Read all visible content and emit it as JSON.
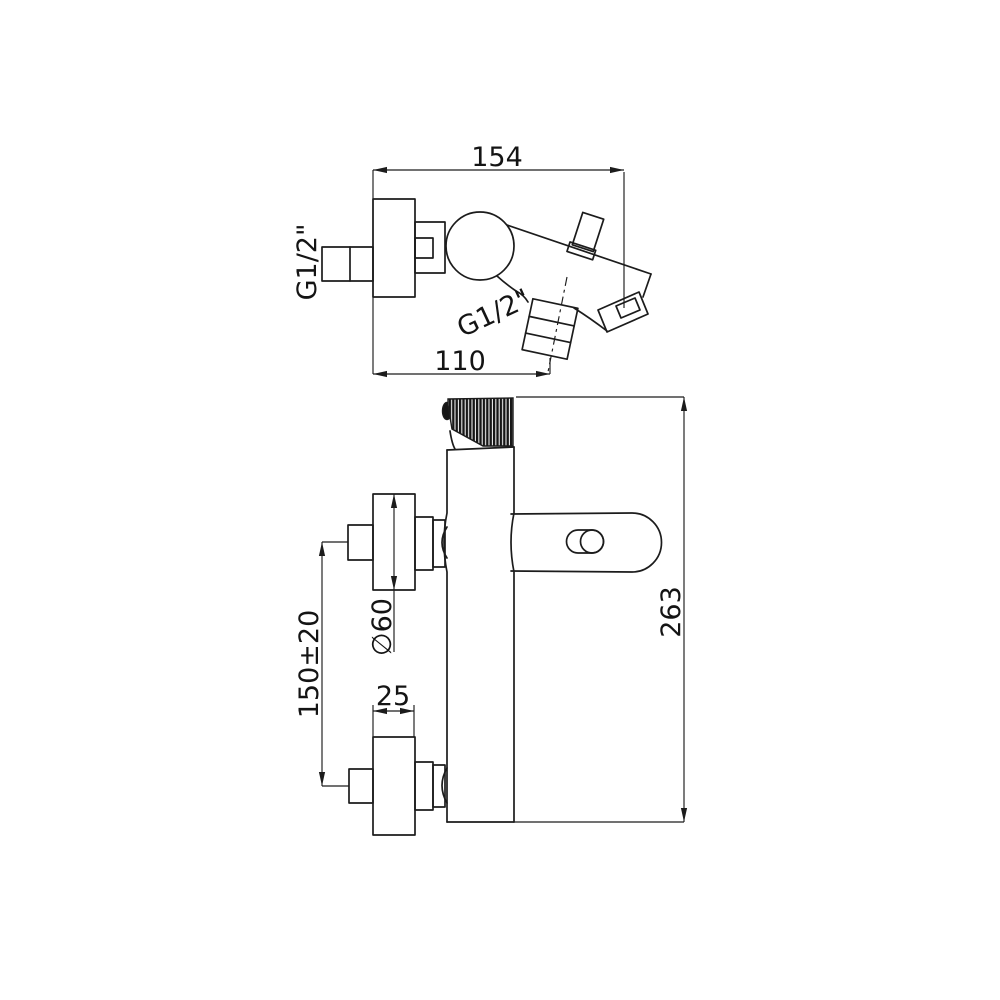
{
  "canvas": {
    "background": "#ffffff",
    "line_color": "#1c1c1c"
  },
  "drawing": {
    "kind": "technical dimension drawing, bath-shower wall mixer, two orthographic views",
    "side_view": {
      "dim_width": "154",
      "dim_reach": "110",
      "inlet_thread_label": "G1/2\"",
      "handshower_thread_label": "G1/2\""
    },
    "front_view": {
      "dim_height": "263",
      "dim_escutcheon_diameter": "∅60",
      "dim_inlet_spacing": "150±20",
      "dim_escutcheon_depth": "25"
    }
  }
}
